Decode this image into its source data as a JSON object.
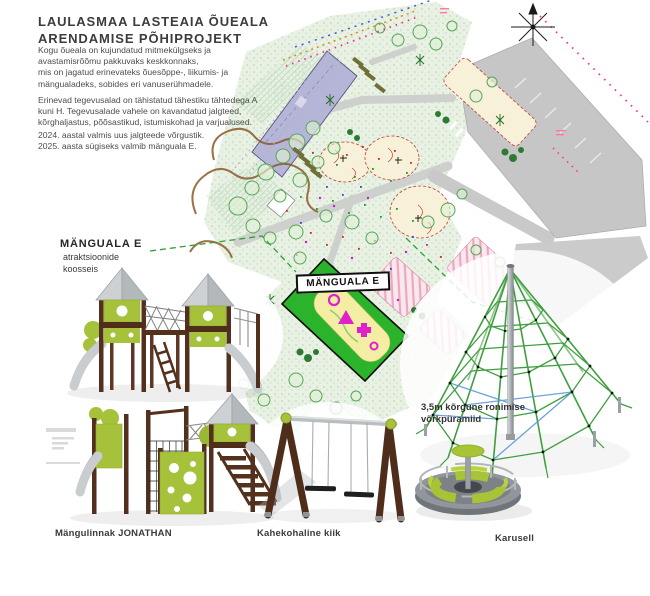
{
  "header": {
    "title_line1": "LAULASMAA LASTEAIA ÕUEALA",
    "title_line2": "ARENDAMISE PÕHIPROJEKT"
  },
  "description": {
    "para1": "Kogu õueala on kujundatud mitmekülgseks ja\navastamisrõõmu pakkuvaks keskkonnaks,\nmis on jagatud erinevateks õuesõppe-, liikumis- ja\nmängualadeks, sobides eri vanuserühmadele.",
    "para2": "Erinevad tegevusalad on tähistatud tähestiku tähtedega A\nkuni H. Tegevusalade vahele on kavandatud jalgteed,\nkõrghaljastus, põõsastikud, istumiskohad ja varjualused.",
    "para3": "2024. aastal valmis uus jalgteede võrgustik.\n2025. aasta sügiseks valmib mänguala E."
  },
  "area_label": {
    "title": "MÄNGUALA E",
    "subtitle": "atraktsioonide\nkoosseis"
  },
  "map": {
    "zone_badge": "MÄNGUALA E",
    "icons": [
      "north-arrow-icon"
    ]
  },
  "equipment": {
    "tower": {
      "caption": "Mängulinnak JONATHAN"
    },
    "swing": {
      "caption": "Kahekohaline kiik"
    },
    "pyramid": {
      "caption": "3,5m kõrgune ronimise\nvõrkpüramiid"
    },
    "carousel": {
      "caption": "Karusell"
    }
  },
  "colors": {
    "zone_highlight_green": "#2cb32c",
    "zone_yellow": "#f3eea4",
    "zone_magenta": "#e020c8",
    "equipment_lime": "#a6c23b",
    "wood_brown": "#52301d",
    "roof_gray": "#c2c6c9",
    "building_lavender": "#b5b5d8",
    "boundary_pink": "#ff2d8a",
    "ground_green": "#e8f1e4"
  }
}
